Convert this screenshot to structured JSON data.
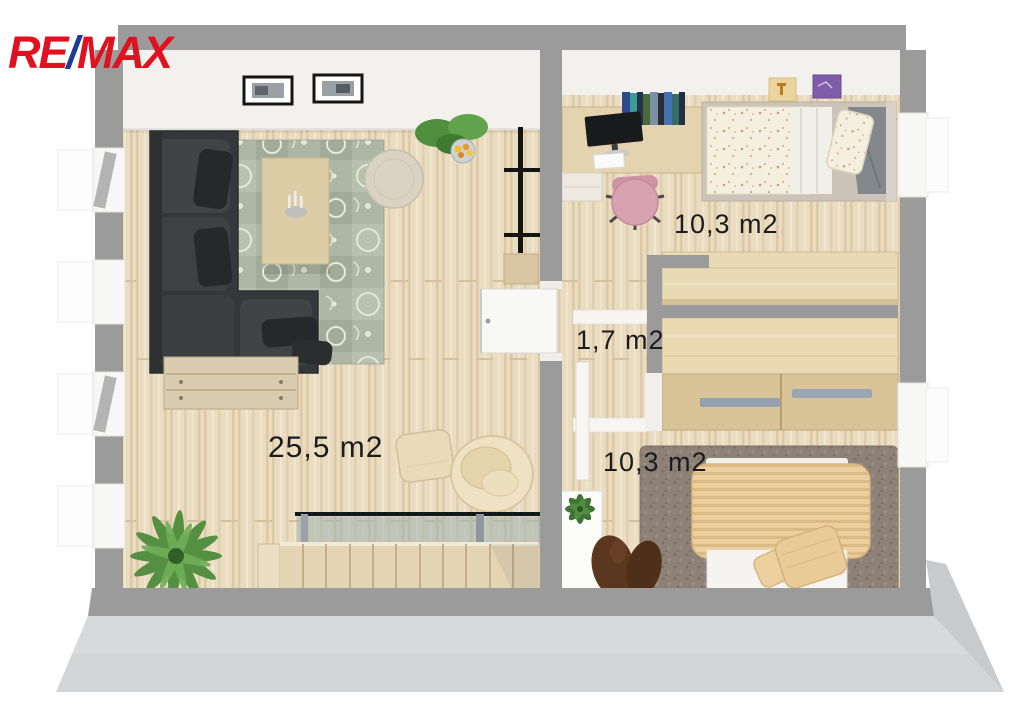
{
  "brand": {
    "re": "RE",
    "slash": "/",
    "max": "MAX",
    "re_color": "#e0121f",
    "slash_color": "#1d3c95"
  },
  "rooms": [
    {
      "name": "living-room",
      "area_label": "25,5 m2"
    },
    {
      "name": "bedroom-top",
      "area_label": "10,3 m2"
    },
    {
      "name": "hallway",
      "area_label": "1,7 m2"
    },
    {
      "name": "bedroom-bottom",
      "area_label": "10,3 m2"
    }
  ],
  "colors": {
    "wall": "#9b9b9b",
    "wall_front_face": "#d3d4d6",
    "floor_wood": "#e9dcc1",
    "rug_sage": "#aeb7a5",
    "rug_taupe": "#8e8177",
    "sofa_dark": "#35383b",
    "duvet_tan": "#eccf9e",
    "label_text": "#1c1c1c"
  }
}
